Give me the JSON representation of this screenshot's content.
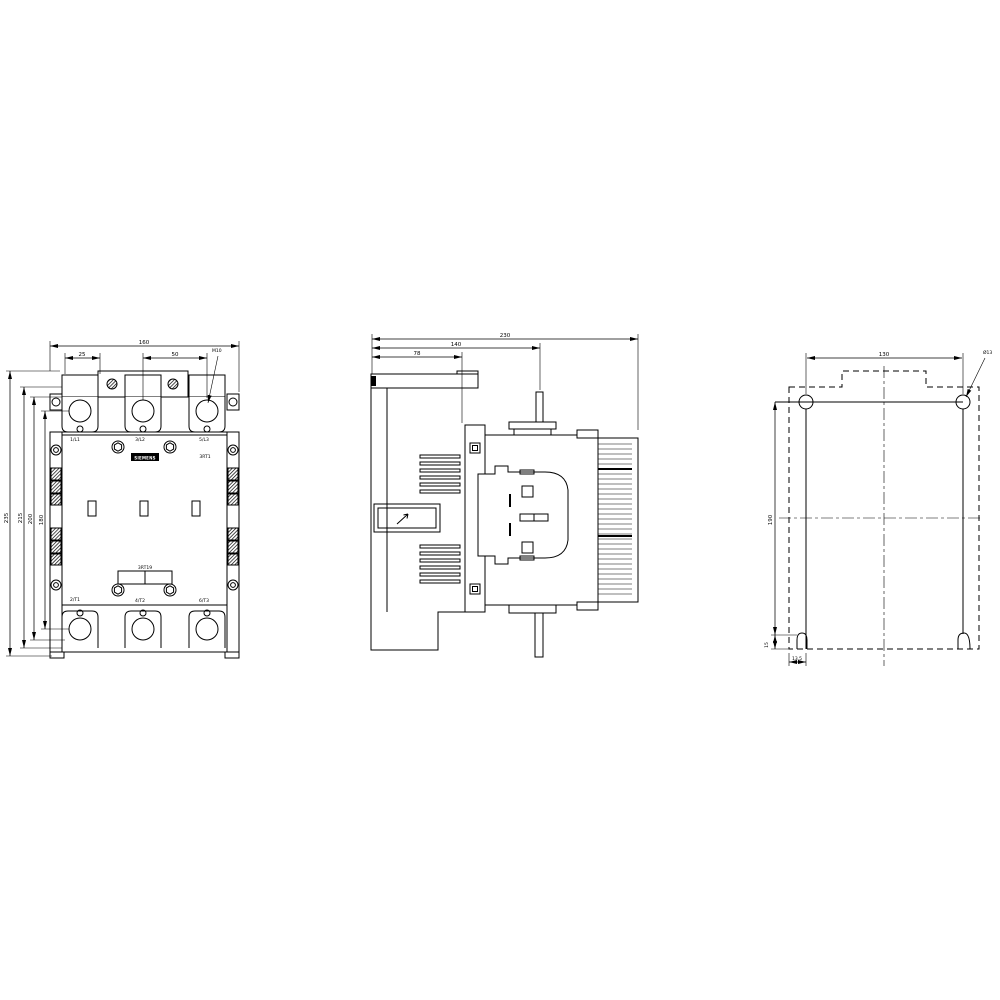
{
  "brand": {
    "label": "SIEMENS"
  },
  "front_view": {
    "terminals_top": [
      "1/L1",
      "3/L2",
      "5/L3"
    ],
    "terminals_bottom": [
      "2/T1",
      "4/T2",
      "6/T3"
    ],
    "product_code": "3RT1",
    "accessory_code": "3RT19",
    "dim_width_total": "160",
    "dim_lug_width": "25",
    "dim_pole_pitch": "50",
    "terminal_hole_callout": "M10",
    "dim_height_outer": "235",
    "dim_height_2": "215",
    "dim_height_3": "200",
    "dim_hole_centers": "180"
  },
  "side_view": {
    "dim_depth_total": "230",
    "dim_depth_to_stud": "140",
    "dim_back_depth": "78"
  },
  "drilling_view": {
    "dim_hole_spacing_h": "130",
    "dim_hole_spacing_v": "190",
    "dim_foot_height": "15",
    "dim_slot_offset": "13,5",
    "hole_callout": "Ø13"
  }
}
